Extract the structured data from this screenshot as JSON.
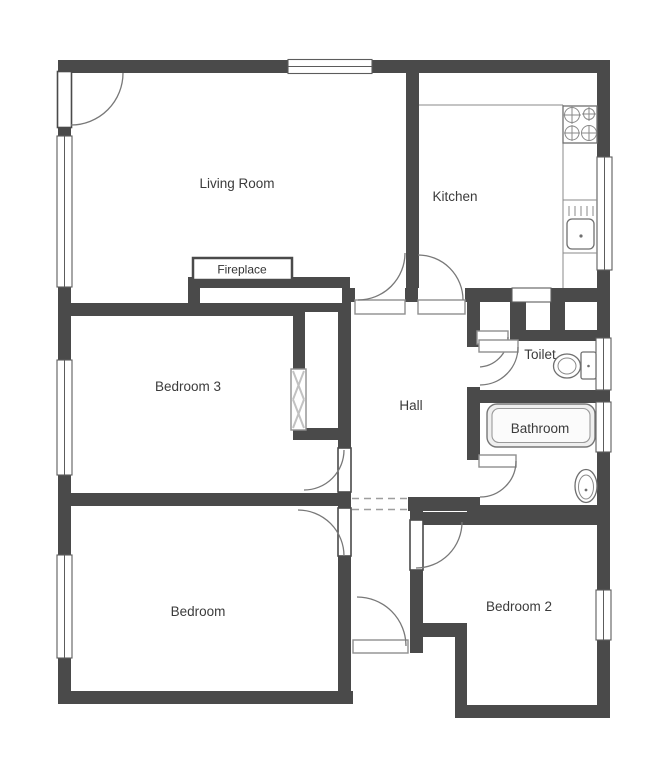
{
  "title": "Apartment floor plan",
  "rooms": {
    "living_room": {
      "label": "Living Room"
    },
    "kitchen": {
      "label": "Kitchen"
    },
    "bedroom3": {
      "label": "Bedroom 3"
    },
    "hall": {
      "label": "Hall"
    },
    "toilet": {
      "label": "Toilet"
    },
    "bathroom": {
      "label": "Bathroom"
    },
    "bedroom": {
      "label": "Bedroom"
    },
    "bedroom2": {
      "label": "Bedroom 2"
    }
  },
  "features": {
    "fireplace": {
      "label": "Fireplace"
    }
  },
  "fixtures": [
    "stove-icon",
    "kitchen-sink-icon",
    "toilet-icon",
    "bathtub-icon",
    "washbasin-icon",
    "wardrobe-icon",
    "serving-hatch"
  ],
  "colors": {
    "wall": "#4a4a4a",
    "label_text": "#3b3b3b",
    "fixture_line": "#6f6f6f",
    "bathtub_fill": "#efefef",
    "background": "#ffffff"
  }
}
